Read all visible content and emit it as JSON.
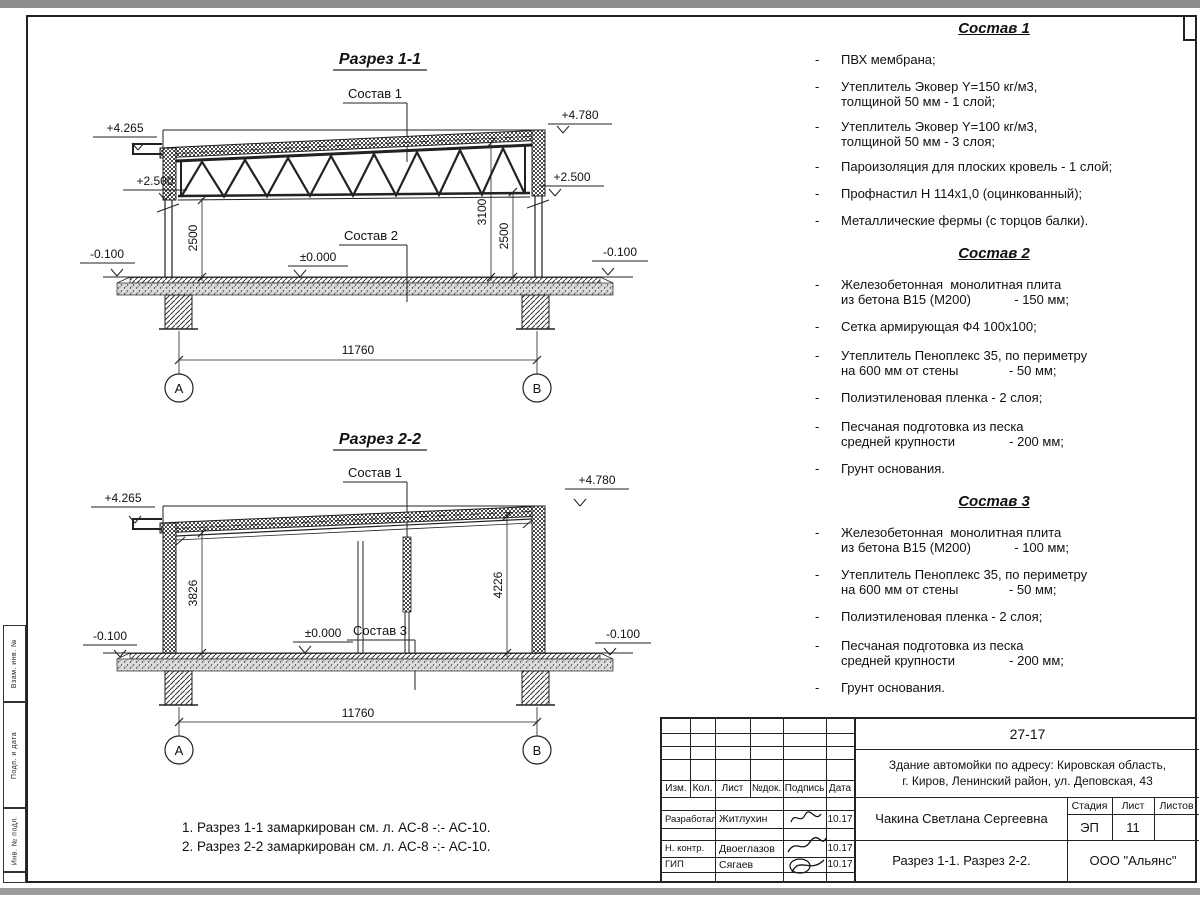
{
  "sheet": {
    "frame": {
      "margin_labels": [
        "Взам. инв. №",
        "Подп. и дата",
        "Инв. № подл."
      ]
    },
    "sections": [
      {
        "title": "Разрез 1-1",
        "callout_top": "Состав 1",
        "callout_mid": "Состав 2",
        "elev_top_left": "+4.265",
        "elev_top_right": "+4.780",
        "elev_mid_left": "+2.500",
        "elev_mid_right": "+2.500",
        "elev_zero": "±0.000",
        "elev_ground_left": "-0.100",
        "elev_ground_right": "-0.100",
        "dim_left": "2500",
        "dim_mid": "3100",
        "dim_right": "2500",
        "dim_span": "11760",
        "axis_left": "А",
        "axis_right": "В"
      },
      {
        "title": "Разрез 2-2",
        "callout_top": "Состав 1",
        "callout_mid": "Состав 3",
        "elev_top_left": "+4.265",
        "elev_top_right": "+4.780",
        "elev_zero": "±0.000",
        "elev_ground_left": "-0.100",
        "elev_ground_right": "-0.100",
        "dim_left": "3826",
        "dim_right": "4226",
        "dim_span": "11760",
        "axis_left": "А",
        "axis_right": "В"
      }
    ],
    "compositions": [
      {
        "heading": "Состав 1",
        "items": [
          [
            "ПВХ мембрана;"
          ],
          [
            "Утеплитель Эковер Y=150 кг/м3,",
            "толщиной 50 мм - 1 слой;"
          ],
          [
            "Утеплитель Эковер Y=100 кг/м3,",
            "толщиной 50 мм - 3 слоя;"
          ],
          [
            "Пароизоляция для плоских кровель - 1 слой;"
          ],
          [
            "Профнастил Н 114х1,0 (оцинкованный);"
          ],
          [
            "Металлические фермы (с торцов балки)."
          ]
        ]
      },
      {
        "heading": "Состав 2",
        "items": [
          [
            "Железобетонная  монолитная плита",
            "из бетона В15 (М200)            - 150 мм;"
          ],
          [
            "Сетка армирующая Ф4 100х100;"
          ],
          [
            "Утеплитель Пеноплекс 35, по периметру",
            "на 600 мм от стены              - 50 мм;"
          ],
          [
            "Полиэтиленовая пленка - 2 слоя;"
          ],
          [
            "Песчаная подготовка из песка",
            "средней крупности               - 200 мм;"
          ],
          [
            "Грунт основания."
          ]
        ]
      },
      {
        "heading": "Состав 3",
        "items": [
          [
            "Железобетонная  монолитная плита",
            "из бетона В15 (М200)            - 100 мм;"
          ],
          [
            "Утеплитель Пеноплекс 35, по периметру",
            "на 600 мм от стены              - 50 мм;"
          ],
          [
            "Полиэтиленовая пленка - 2 слоя;"
          ],
          [
            "Песчаная подготовка из песка",
            "средней крупности               - 200 мм;"
          ],
          [
            "Грунт основания."
          ]
        ]
      }
    ],
    "notes": [
      "1. Разрез 1-1 замаркирован см. л. АС-8 -:- АС-10.",
      "2. Разрез 2-2 замаркирован см. л. АС-8 -:- АС-10."
    ],
    "title_block": {
      "doc_number": "27-17",
      "object_line1": "Здание автомойки по адресу: Кировская область,",
      "object_line2": "г. Киров, Ленинский район, ул. Деповская, 43",
      "customer": "Чакина Светлана Сергеевна",
      "sheet_title": "Разрез 1-1. Разрез 2-2.",
      "company": "ООО \"Альянс\"",
      "col_izm": "Изм.",
      "col_kol": "Кол.",
      "col_list": "Лист",
      "col_doc": "№док.",
      "col_sign": "Подпись",
      "col_date": "Дата",
      "stage_label": "Стадия",
      "sheet_label": "Лист",
      "sheets_label": "Листов",
      "stage": "ЭП",
      "sheet_no": "11",
      "sheets_total": "",
      "rows": [
        {
          "role": "Разработал",
          "name": "Житлухин",
          "date": "10.17"
        },
        {
          "role": "Н. контр.",
          "name": "Двоеглазов",
          "date": "10.17"
        },
        {
          "role": "ГИП",
          "name": "Сягаев",
          "date": "10.17"
        }
      ]
    }
  }
}
